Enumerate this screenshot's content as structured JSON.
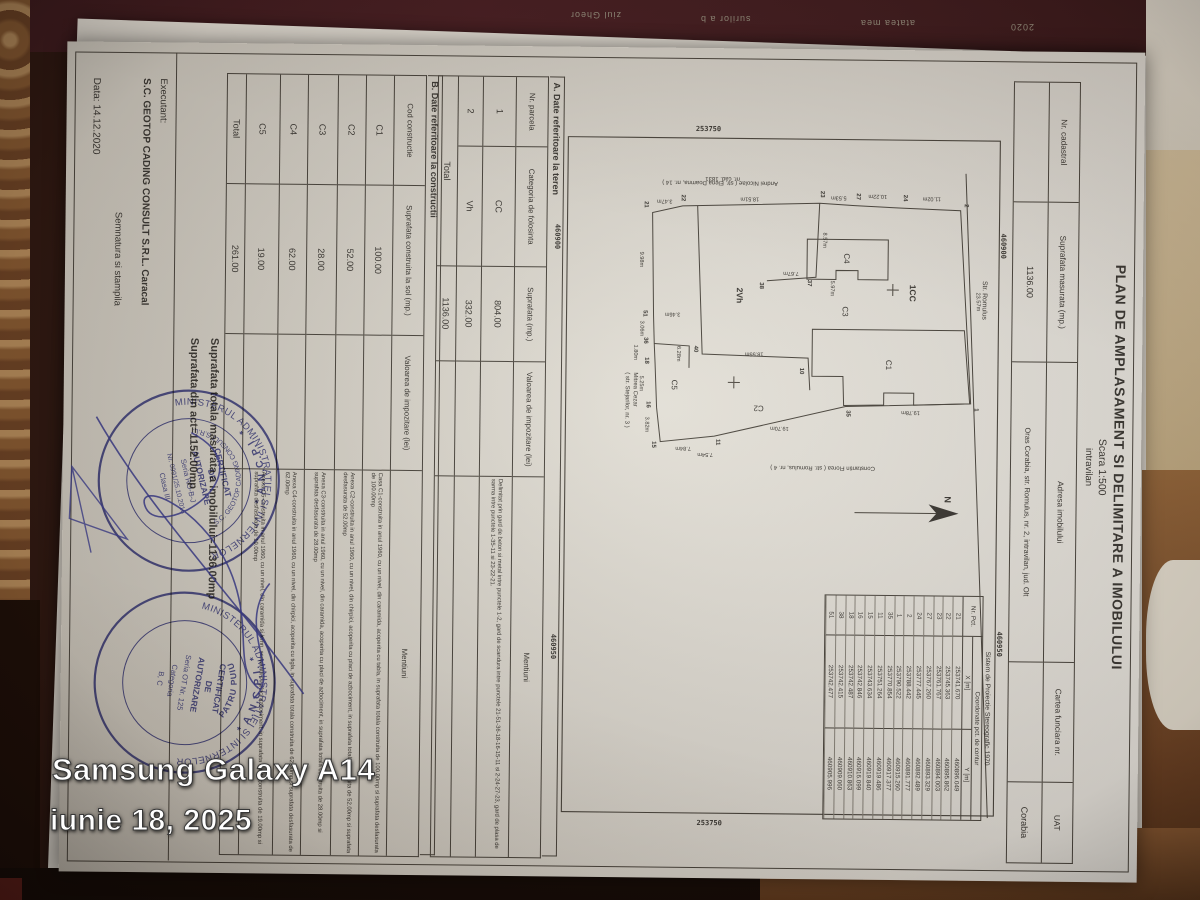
{
  "watermark": {
    "device": "Samsung Galaxy A14",
    "date": "iunie 18, 2025"
  },
  "background_fragments": {
    "top1": "ziul Gheor",
    "top2": "surilor a b",
    "top3": "atatea mea",
    "top4": "2020",
    "side1": "UNIUN KENZL BIROU",
    "side2": "82709 FS"
  },
  "document": {
    "title": "PLAN DE AMPLASAMENT SI DELIMITARE A IMOBILULUI",
    "scale": "Scara 1:500",
    "zone": "intravilan",
    "header": {
      "nr_cadastral_label": "Nr. cadastral",
      "suprafata_label": "Suprafata masurata (mp.)",
      "adresa_label": "Adresa imobilului",
      "cf_label": "Cartea funciara nr.",
      "uat_label": "UAT",
      "nr_cadastral": "",
      "suprafata": "1136.00",
      "adresa": "Oras Corabia, str. Romulus, nr. 2, intravilan, jud. Olt",
      "cf": "",
      "uat": "Corabia"
    },
    "plan": {
      "north_label": "N",
      "street": "Str. Romulus",
      "labels": {
        "parcel_cc": "1CC",
        "parcel_vh": "2Vh",
        "c1": "C1",
        "c2": "C2",
        "c3": "C3",
        "c4": "C4",
        "c5": "C5",
        "nr_cad": "nr. cad. 1831"
      },
      "neighbors": {
        "west": "Andrei Nicolae ( str. Elena Doamna, nr. 14 )",
        "east": "Constantin Florea ( str. Romulus, nr. 4 )",
        "south_line1": "Mitrea Cezar",
        "south_line2": "( str. Stejarilor, nr. 3 )"
      },
      "grid": {
        "x_label": "253750",
        "y1_label": "460900",
        "y2_label": "460950"
      },
      "points": [
        {
          "n": "2",
          "x": 130,
          "y": 43
        },
        {
          "n": "1",
          "x": 334,
          "y": 31
        },
        {
          "n": "24",
          "x": 123,
          "y": 104
        },
        {
          "n": "27",
          "x": 122,
          "y": 151
        },
        {
          "n": "23",
          "x": 120,
          "y": 187
        },
        {
          "n": "22",
          "x": 125,
          "y": 326
        },
        {
          "n": "21",
          "x": 132,
          "y": 363
        },
        {
          "n": "51",
          "x": 241,
          "y": 363
        },
        {
          "n": "36",
          "x": 268,
          "y": 362
        },
        {
          "n": "18",
          "x": 288,
          "y": 361
        },
        {
          "n": "16",
          "x": 332,
          "y": 359
        },
        {
          "n": "15",
          "x": 372,
          "y": 353
        },
        {
          "n": "11",
          "x": 369,
          "y": 289
        },
        {
          "n": "35",
          "x": 339,
          "y": 159
        },
        {
          "n": "40",
          "x": 276,
          "y": 312
        },
        {
          "n": "37",
          "x": 209,
          "y": 199
        },
        {
          "n": "38",
          "x": 212,
          "y": 247
        },
        {
          "n": "10",
          "x": 297,
          "y": 206
        }
      ],
      "dims": [
        {
          "t": "23.57m",
          "x": 226,
          "y": 30,
          "r": -2
        },
        {
          "t": "11.02m",
          "x": 122,
          "y": 76,
          "r": 90
        },
        {
          "t": "10.22m",
          "x": 120,
          "y": 130,
          "r": 90
        },
        {
          "t": "5.53m",
          "x": 122,
          "y": 169,
          "r": 90
        },
        {
          "t": "8.57m",
          "x": 166,
          "y": 184,
          "r": 0
        },
        {
          "t": "18.51m",
          "x": 124,
          "y": 258,
          "r": 90
        },
        {
          "t": "3.47m",
          "x": 127,
          "y": 343,
          "r": 90
        },
        {
          "t": "9.98m",
          "x": 187,
          "y": 367,
          "r": 0
        },
        {
          "t": "3.06m",
          "x": 256,
          "y": 366,
          "r": 0
        },
        {
          "t": "1.80m",
          "x": 280,
          "y": 372,
          "r": 0
        },
        {
          "t": "5.25m",
          "x": 311,
          "y": 366,
          "r": 0
        },
        {
          "t": "3.82m",
          "x": 352,
          "y": 360,
          "r": 0
        },
        {
          "t": "7.54m",
          "x": 380,
          "y": 300,
          "r": 90
        },
        {
          "t": "7.84m",
          "x": 374,
          "y": 322,
          "r": 90
        },
        {
          "t": "19.78m",
          "x": 336,
          "y": 95,
          "r": 90
        },
        {
          "t": "19.70m",
          "x": 353,
          "y": 226,
          "r": 90
        },
        {
          "t": "18.55m",
          "x": 279,
          "y": 252,
          "r": 90
        },
        {
          "t": "6.28m",
          "x": 281,
          "y": 329,
          "r": 0
        },
        {
          "t": "3.46m",
          "x": 240,
          "y": 334,
          "r": 90
        },
        {
          "t": "7.67m",
          "x": 198,
          "y": 216,
          "r": 90
        },
        {
          "t": "5.97m",
          "x": 214,
          "y": 176,
          "r": 0
        }
      ]
    },
    "coord_table": {
      "title": "Sistem de Proiectie Stereografic 1970",
      "header": "Coordonate pct. de contur",
      "col_pct": "Nr. Pct.",
      "col_x": "X [m]",
      "col_y": "Y [m]",
      "rows": [
        [
          "21",
          "253741.670",
          "460896.049"
        ],
        [
          "22",
          "253745.363",
          "460895.862"
        ],
        [
          "23",
          "253761.767",
          "460894.003"
        ],
        [
          "27",
          "253767.260",
          "460893.329"
        ],
        [
          "24",
          "253777.445",
          "460892.489"
        ],
        [
          "2",
          "253788.442",
          "460891.777"
        ],
        [
          "1",
          "253790.522",
          "460915.260"
        ],
        [
          "35",
          "253770.854",
          "460917.377"
        ],
        [
          "11",
          "253751.264",
          "460919.486"
        ],
        [
          "15",
          "253743.634",
          "460919.840"
        ],
        [
          "16",
          "253742.846",
          "460916.099"
        ],
        [
          "18",
          "253742.487",
          "460910.863"
        ],
        [
          "38",
          "253742.415",
          "460909.060"
        ],
        [
          "51",
          "253742.477",
          "460905.996"
        ]
      ]
    },
    "section_a": {
      "title": "A. Date referitoare la teren",
      "col_nr": "Nr. parcela",
      "col_cat": "Categoria de folosinta",
      "col_sup": "Suprafata (mp.)",
      "col_val": "Valoarea de impozitare (lei)",
      "col_men": "Mentiuni",
      "rows": [
        {
          "nr": "1",
          "cat": "CC",
          "sup": "804.00",
          "val": "",
          "men": "Delimitat prin gard de beton si metal intre punctele 1-2, gard de scandura intre punctele 21-51-36-18-16-15-11 si 2-24-27-23, gard de plasa de sarma intre punctele 1-35-11 si 23-22-21."
        },
        {
          "nr": "2",
          "cat": "Vh",
          "sup": "332.00",
          "val": "",
          "men": ""
        }
      ],
      "total_label": "Total",
      "total": "1136.00"
    },
    "section_b": {
      "title": "B. Date referitoare la constructii",
      "col_cod": "Cod constructie",
      "col_sup": "Suprafata construita la sol (mp.)",
      "col_val": "Valoarea de impozitare (lei)",
      "col_men": "Mentiuni",
      "rows": [
        {
          "cod": "C1",
          "sup": "100.00",
          "val": "",
          "men": "Casa C1-construita in anul 1960, cu un nivel, din caramida, acoperita cu tabla, in suprafata totala construita de 100.00mp si suprafata desfasurata de 100.00mp"
        },
        {
          "cod": "C2",
          "sup": "52.00",
          "val": "",
          "men": "Anexa C2-construita in anul 1960, cu un nivel, din chirpici, acoperita cu placi de azbociment, in suprafata totala construita de 52.00mp si suprafata desfasurata de 52.00mp"
        },
        {
          "cod": "C3",
          "sup": "28.00",
          "val": "",
          "men": "Anexa C3-construita in anul 1960, cu un nivel, din caramida, acoperita cu placi de azbociment, in suprafata totala construita de 28.00mp si suprafata desfasurata de 28.00mp"
        },
        {
          "cod": "C4",
          "sup": "62.00",
          "val": "",
          "men": "Anexa C4-construita in anul 1960, cu un nivel, din chirpici, acoperita cu tigla, in suprafata totala construita de 62.00mp si suprafata desfasurata de 62.00mp"
        },
        {
          "cod": "C5",
          "sup": "19.00",
          "val": "",
          "men": "Anexa C5-construita in anul 1960, cu un nivel, din caramida si lemn, acoperita cu placi azbociment, in suprafata totala construita de 19.00mp si suprafata desfasurata de 19.00mp"
        }
      ],
      "total_label": "Total",
      "total": "261.00"
    },
    "totals": {
      "line1": "Suprafata totala masurata a imobilului=1136.00mp",
      "line2": "Suprafata din act=1152.00mp"
    },
    "footer": {
      "executant_label": "Executant:",
      "executant": "S.C. GEOTOP CADING CONSULT S.R.L. Caracal",
      "semnatura": "Semnatura si stampila",
      "data": "Data: 14.12.2020"
    },
    "stamps": {
      "ring_top": "MINISTERUL ADMINISTRATIEI SI INTERNELOR",
      "ring_bottom": "* A.N.C.P.I. *",
      "stamp1": {
        "l1": "CERTIFICAT",
        "l2": "DE",
        "l3": "AUTORIZARE",
        "l4": "Seria RO-B-J",
        "l5": "Nr. 0991/25.10.2016",
        "l6": "Clasa III",
        "inner": "S.C. GEOTOP CADING CONSULT S.R.L."
      },
      "stamp2": {
        "l1": "CERTIFICAT",
        "l2": "DE",
        "l3": "AUTORIZARE",
        "l4": "Seria OT Nr. 125",
        "l5": "Categoria",
        "l6": "B, C",
        "inner": "PATRU PUIU"
      }
    }
  }
}
